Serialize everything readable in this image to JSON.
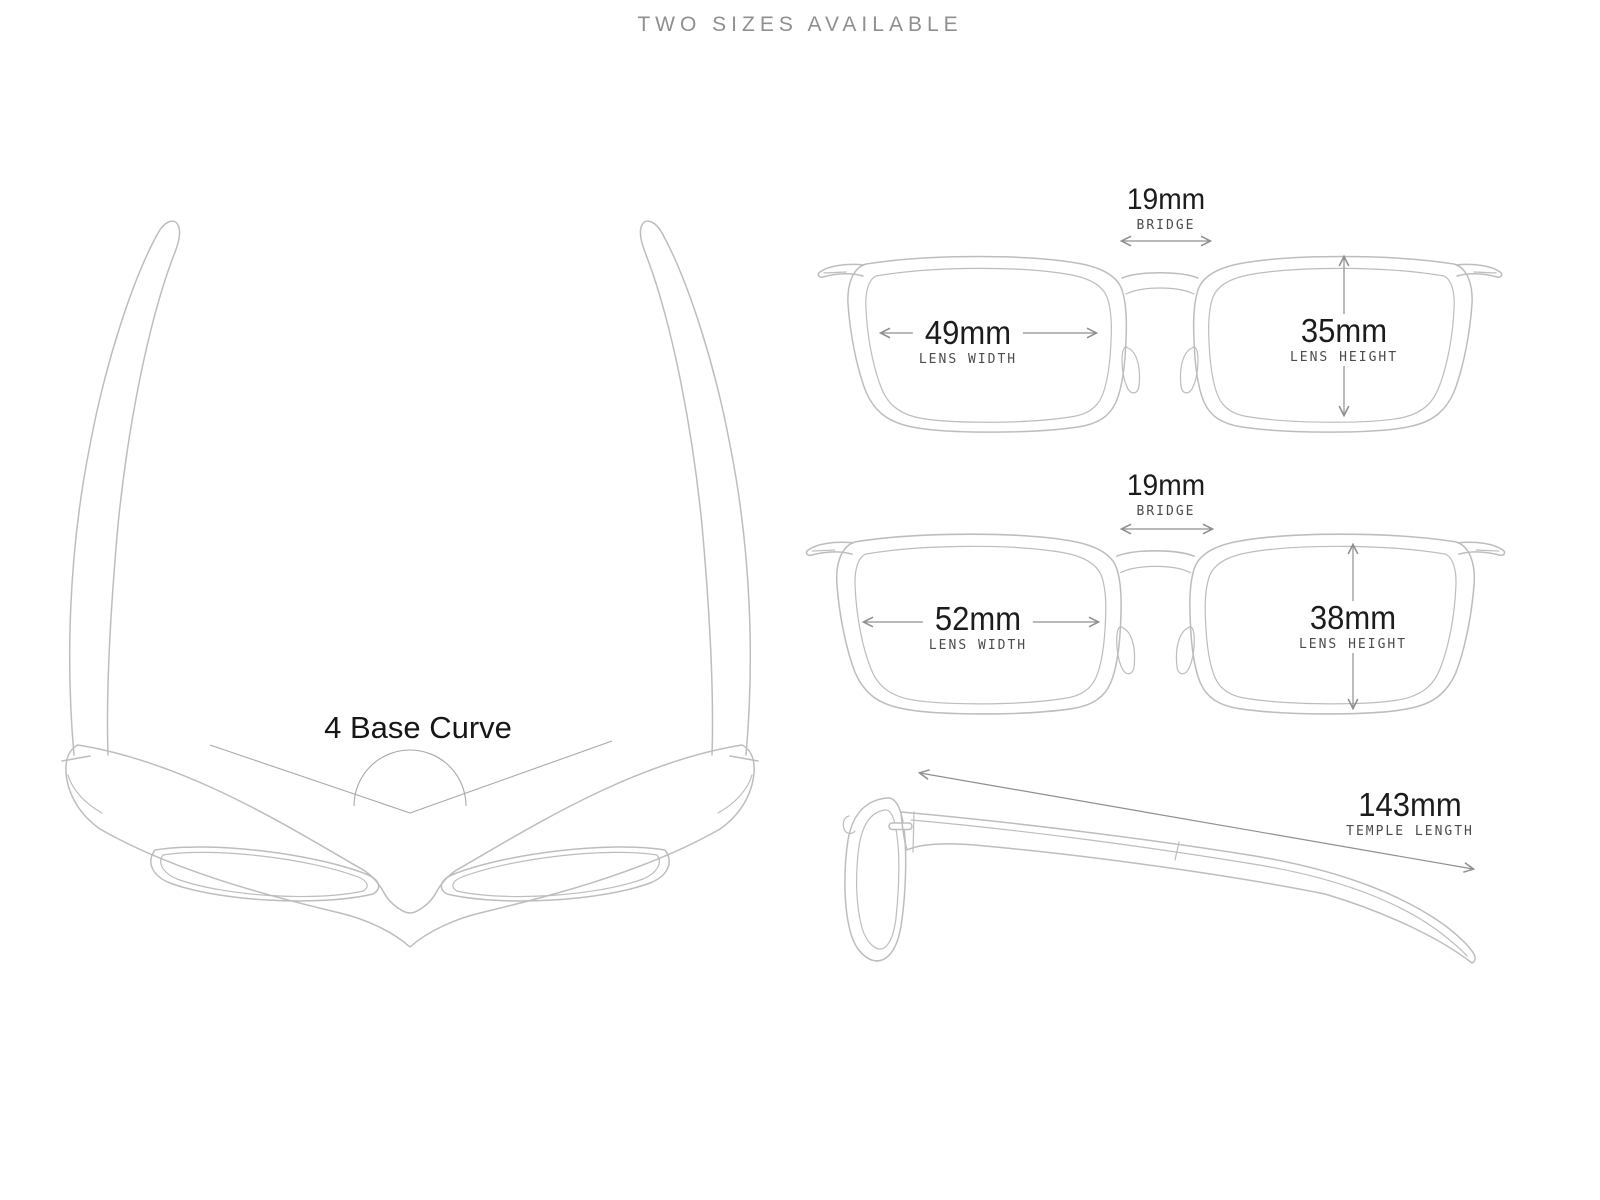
{
  "title": "TWO SIZES AVAILABLE",
  "top_view": {
    "base_curve_label": "4 Base Curve"
  },
  "sizes": [
    {
      "bridge_value": "19mm",
      "bridge_label": "BRIDGE",
      "lens_width_value": "49mm",
      "lens_width_label": "LENS WIDTH",
      "lens_height_value": "35mm",
      "lens_height_label": "LENS HEIGHT"
    },
    {
      "bridge_value": "19mm",
      "bridge_label": "BRIDGE",
      "lens_width_value": "52mm",
      "lens_width_label": "LENS WIDTH",
      "lens_height_value": "38mm",
      "lens_height_label": "LENS HEIGHT"
    }
  ],
  "side_view": {
    "temple_value": "143mm",
    "temple_label": "TEMPLE LENGTH"
  },
  "colors": {
    "background": "#ffffff",
    "line_art": "#bdbdbd",
    "arrow": "#8f8f8f",
    "annotation_line": "#a8a8a8",
    "number_text": "#1c1c1c",
    "label_text": "#4b4b4b",
    "title_text": "#8f8f8f"
  }
}
